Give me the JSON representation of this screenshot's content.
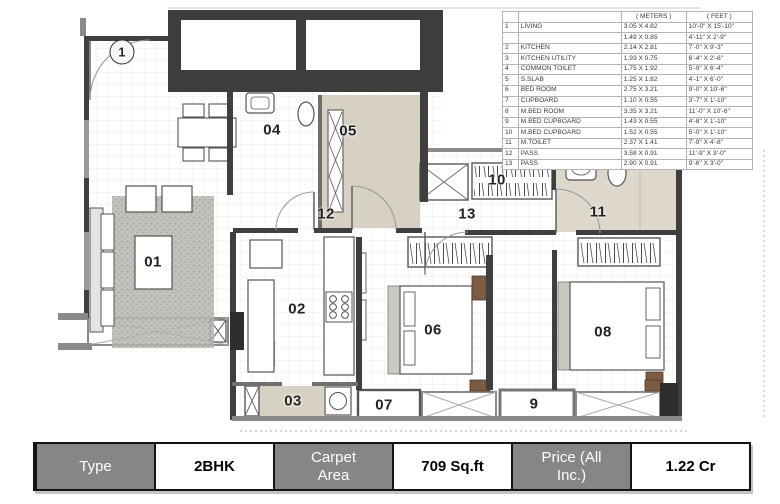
{
  "legend": {
    "headers": {
      "meters": "( METERS )",
      "feet": "( FEET )"
    },
    "rows": [
      {
        "num": "1",
        "name": "LIVING",
        "meters": "3.05 X 4.82",
        "feet": "10'-0\" X 15'-10\""
      },
      {
        "num": "",
        "name": "",
        "meters": "1.49 X 0.85",
        "feet": "4'-11\" X 2'-9\""
      },
      {
        "num": "2",
        "name": "KITCHEN",
        "meters": "2.14 X 2.81",
        "feet": "7'-0\" X 9'-3\""
      },
      {
        "num": "3",
        "name": "KITCHEN UTILITY",
        "meters": "1.93 X 0.75",
        "feet": "6'-4\" X 2'-6\""
      },
      {
        "num": "4",
        "name": "COMMON TOILET",
        "meters": "1.75 X 1.92",
        "feet": "5'-9\" X 6'-4\""
      },
      {
        "num": "5",
        "name": "S.SLAB",
        "meters": "1.25 X 1.82",
        "feet": "4'-1\" X 6'-0\""
      },
      {
        "num": "6",
        "name": "BED ROOM",
        "meters": "2.75 X 3.21",
        "feet": "9'-0\" X 10'-6\""
      },
      {
        "num": "7",
        "name": "CUPBOARD",
        "meters": "1.10 X 0.55",
        "feet": "3'-7\" X 1'-10\""
      },
      {
        "num": "8",
        "name": "M.BED ROOM",
        "meters": "3.35 X 3.21",
        "feet": "11'-0\" X 10'-6\""
      },
      {
        "num": "9",
        "name": "M.BED CUPBOARD",
        "meters": "1.43 X 0.55",
        "feet": "4'-8\" X 1'-10\""
      },
      {
        "num": "10",
        "name": "M.BED CUPBOARD",
        "meters": "1.52 X 0.55",
        "feet": "5'-0\" X 1'-10\""
      },
      {
        "num": "11",
        "name": "M.TOILET",
        "meters": "2.37 X 1.41",
        "feet": "7'-9\" X 4'-8\""
      },
      {
        "num": "12",
        "name": "PASS",
        "meters": "3.58 X 0.91",
        "feet": "11'-9\" X 3'-0\""
      },
      {
        "num": "13",
        "name": "PASS",
        "meters": "2.90 X 0.91",
        "feet": "9'-6\" X 3'-0\""
      }
    ]
  },
  "plan": {
    "labels": [
      {
        "text": "1",
        "x": 122,
        "y": 52,
        "circled": true
      },
      {
        "text": "04",
        "x": 272,
        "y": 130
      },
      {
        "text": "05",
        "x": 348,
        "y": 131
      },
      {
        "text": "12",
        "x": 326,
        "y": 214
      },
      {
        "text": "13",
        "x": 467,
        "y": 214
      },
      {
        "text": "10",
        "x": 497,
        "y": 180
      },
      {
        "text": "11",
        "x": 598,
        "y": 212
      },
      {
        "text": "01",
        "x": 153,
        "y": 262
      },
      {
        "text": "02",
        "x": 297,
        "y": 309
      },
      {
        "text": "06",
        "x": 433,
        "y": 330
      },
      {
        "text": "08",
        "x": 603,
        "y": 332
      },
      {
        "text": "03",
        "x": 293,
        "y": 401
      },
      {
        "text": "07",
        "x": 384,
        "y": 405
      },
      {
        "text": "9",
        "x": 534,
        "y": 404
      }
    ]
  },
  "info_bar": {
    "cells": [
      {
        "label": "Type",
        "variant": "header"
      },
      {
        "label": "2BHK",
        "variant": "value"
      },
      {
        "label": "Carpet Area",
        "variant": "header"
      },
      {
        "label": "709 Sq.ft",
        "variant": "value"
      },
      {
        "label": "Price (All Inc.)",
        "variant": "header"
      },
      {
        "label": "1.22 Cr",
        "variant": "value"
      }
    ]
  },
  "colors": {
    "bar_gray": "#868686",
    "wall_dark": "#3d3d3d",
    "toilet_floor": "#d7d1c3"
  }
}
